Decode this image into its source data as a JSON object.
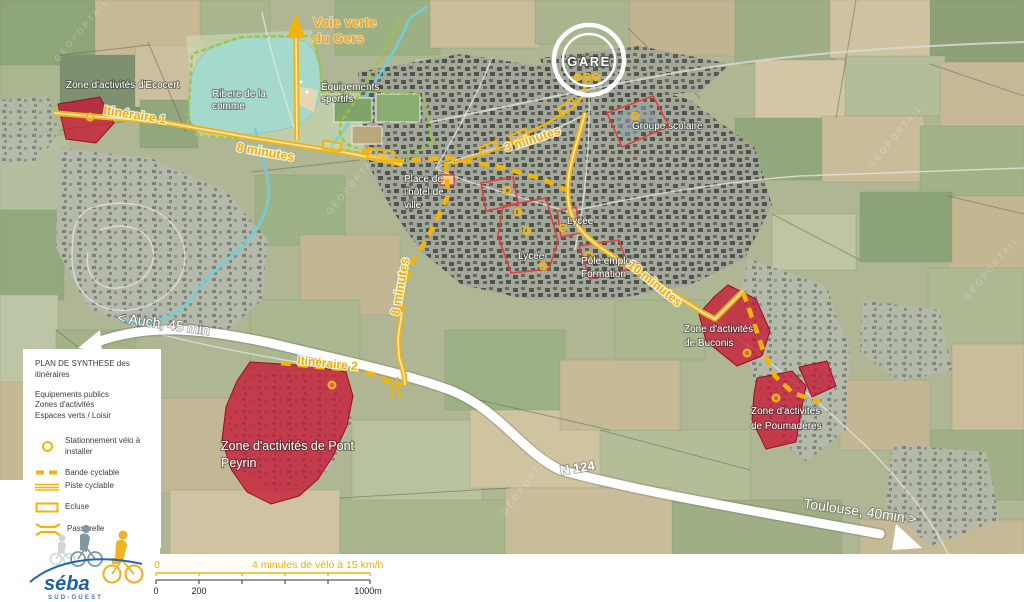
{
  "map": {
    "labels": {
      "voie_verte_line1": "Voie verte",
      "voie_verte_line2": "du Gers",
      "ecocert": "Zone d'activités d'Ecocert",
      "ribere_line1": "Ribere de la",
      "ribere_line2": "comme",
      "equipements_line1": "Équipements",
      "equipements_line2": "sportifs",
      "gare": "GARE",
      "groupe_scolaire": "Groupe scolaire",
      "itineraire_1": "Itinéraire 1",
      "minutes_8_route1": "8 minutes",
      "minutes_3": "3 minutes",
      "place_line1": "Place de",
      "place_line2": "l'hôtel de",
      "place_line3": "ville",
      "lycee_east": "Lycée",
      "lycee_south": "Lycée",
      "pole_emploi_line1": "Pôle emploi",
      "pole_emploi_line2": "Formation",
      "minutes_10": "10 minutes",
      "minutes_8_south": "8 minutes",
      "buconis_line1": "Zone d'activités",
      "buconis_line2": "de Buconis",
      "poumaderes_line1": "Zone d'activités",
      "poumaderes_line2": "de Poumadères",
      "itineraire_2": "Itinéraire 2",
      "pont_peyrin_line1": "Zone d'activités de Pont",
      "pont_peyrin_line2": "Peyrin",
      "auch": "< Auch, 45 min",
      "n124": "N 124",
      "toulouse": "Toulouse, 40min >",
      "watermark": "GEOPORTAIL"
    }
  },
  "legend": {
    "title_line1": "PLAN DE SYNTHESE des",
    "title_line2": "itinéraires",
    "cat_equipements": "Equipements publics",
    "cat_zones": "Zones d'activités",
    "cat_espaces": "Espaces verts / Loisir",
    "parking": "Stationnement vélo à installer",
    "bande": "Bande cyclable",
    "piste": "Piste cyclable",
    "ecluse": "Ecluse",
    "passerelle": "Passerelle"
  },
  "scalebar": {
    "zero_yellow": "0",
    "minutes_label": "4 minutes de vélo à 15 km/h",
    "tick_0": "0",
    "tick_200": "200",
    "tick_1000": "1000m"
  },
  "logo": {
    "brand": "séba",
    "region": "SUD-OUEST"
  },
  "colors": {
    "route_yellow": "#f2b40b",
    "zone_red": "#c8102e",
    "zone_outline_red": "#e04040",
    "green_dashed": "#97c83d",
    "water": "#6fd0da",
    "voie_verte_text": "#f5a31b",
    "brand_blue": "#1b5fa8"
  }
}
